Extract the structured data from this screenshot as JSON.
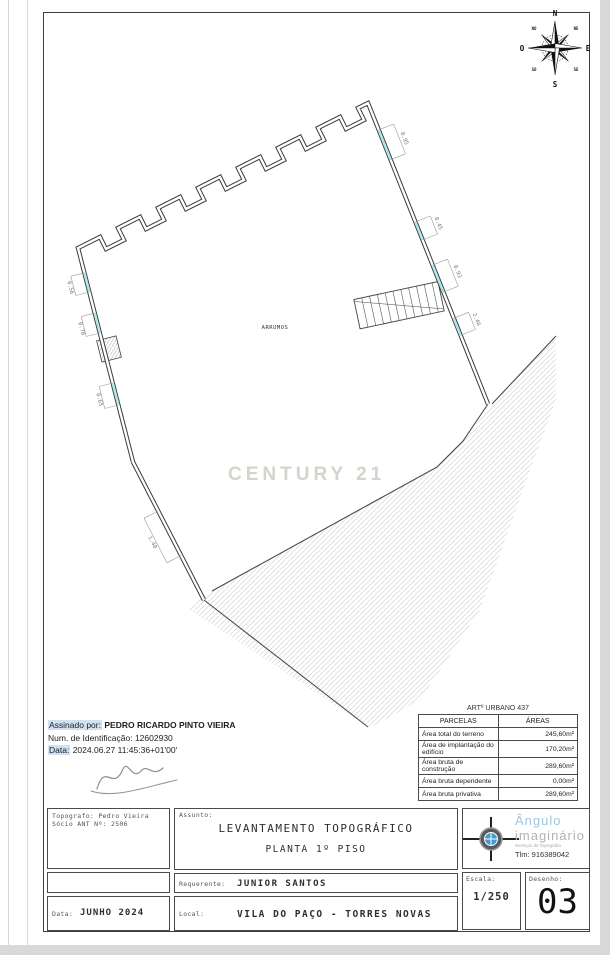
{
  "compass": {
    "north": "N",
    "south": "S",
    "east": "E",
    "west": "O",
    "ne": "NE",
    "nw": "NO",
    "se": "SE",
    "sw": "SO"
  },
  "plan": {
    "room_label": "ARRUMOS",
    "dims": {
      "d1": "0.95",
      "d2": "0.45",
      "d3": "0.93",
      "d4": "2.46",
      "d5": "0.56",
      "d6": "0.70",
      "d7": "0.65",
      "d8": "1.40"
    }
  },
  "watermark": "CENTURY 21",
  "signature": {
    "signed_by_label": "Assinado por:",
    "signed_by_name": "PEDRO RICARDO PINTO VIEIRA",
    "id_label": "Num. de Identificação:",
    "id_value": "12602930",
    "date_label": "Data:",
    "date_value": "2024.06.27 11:45:36+01'00'"
  },
  "areas_table": {
    "title": "ARTº URBANO 437",
    "header": {
      "col1": "PARCELAS",
      "col2": "ÁREAS"
    },
    "rows": [
      {
        "label": "Área total do terreno",
        "value": "245,60m²"
      },
      {
        "label": "Área de implantação do edifício",
        "value": "170,20m²"
      },
      {
        "label": "Área bruta de construção",
        "value": "289,60m²"
      },
      {
        "label": "Área bruta dependente",
        "value": "0,00m²"
      },
      {
        "label": "Área bruta privativa",
        "value": "289,60m²"
      }
    ]
  },
  "title_block": {
    "surveyor_line1": "Topografo: Pedro Vieira",
    "surveyor_line2": "Sócio ANT Nº: 2506",
    "date_label": "Data:",
    "date_value": "JUNHO 2024",
    "subject_label": "Assunto:",
    "subject_line1": "LEVANTAMENTO TOPOGRÁFICO",
    "subject_line2": "PLANTA 1º PISO",
    "client_label": "Requerente:",
    "client_value": "JUNIOR SANTOS",
    "location_label": "Local:",
    "location_value": "VILA DO PAÇO - TORRES NOVAS",
    "logo_name1": "Ângulo",
    "logo_name2": "imaginário",
    "logo_tagline": "Serviços  de  Topografia",
    "phone": "Tlm:  916389042",
    "scale_label": "Escala:",
    "scale_value": "1/250",
    "drawing_label": "Desenho:",
    "drawing_value": "03",
    "accent_blue": "#9ec7db",
    "window_cyan": "#aee7ef"
  }
}
